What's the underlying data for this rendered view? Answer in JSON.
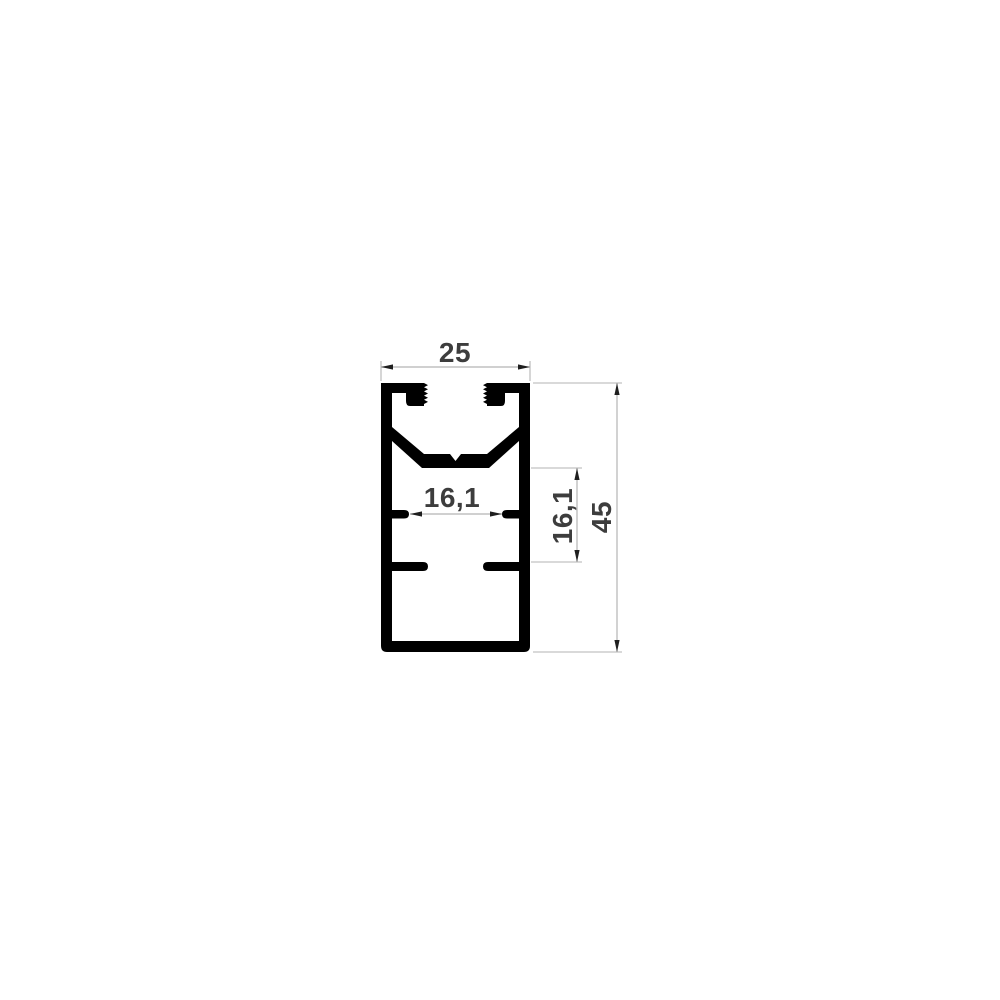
{
  "drawing": {
    "type": "technical-cross-section",
    "subject": "aluminium-profile",
    "background_color": "#ffffff",
    "profile_color": "#000000",
    "dimension_line_color": "#b3b3b3",
    "arrow_color": "#1f1f1f",
    "text_color": "#3d3d3d",
    "dimensions": {
      "overall_width": "25",
      "overall_height": "45",
      "inner_width": "16,1",
      "inner_height": "16,1"
    }
  }
}
